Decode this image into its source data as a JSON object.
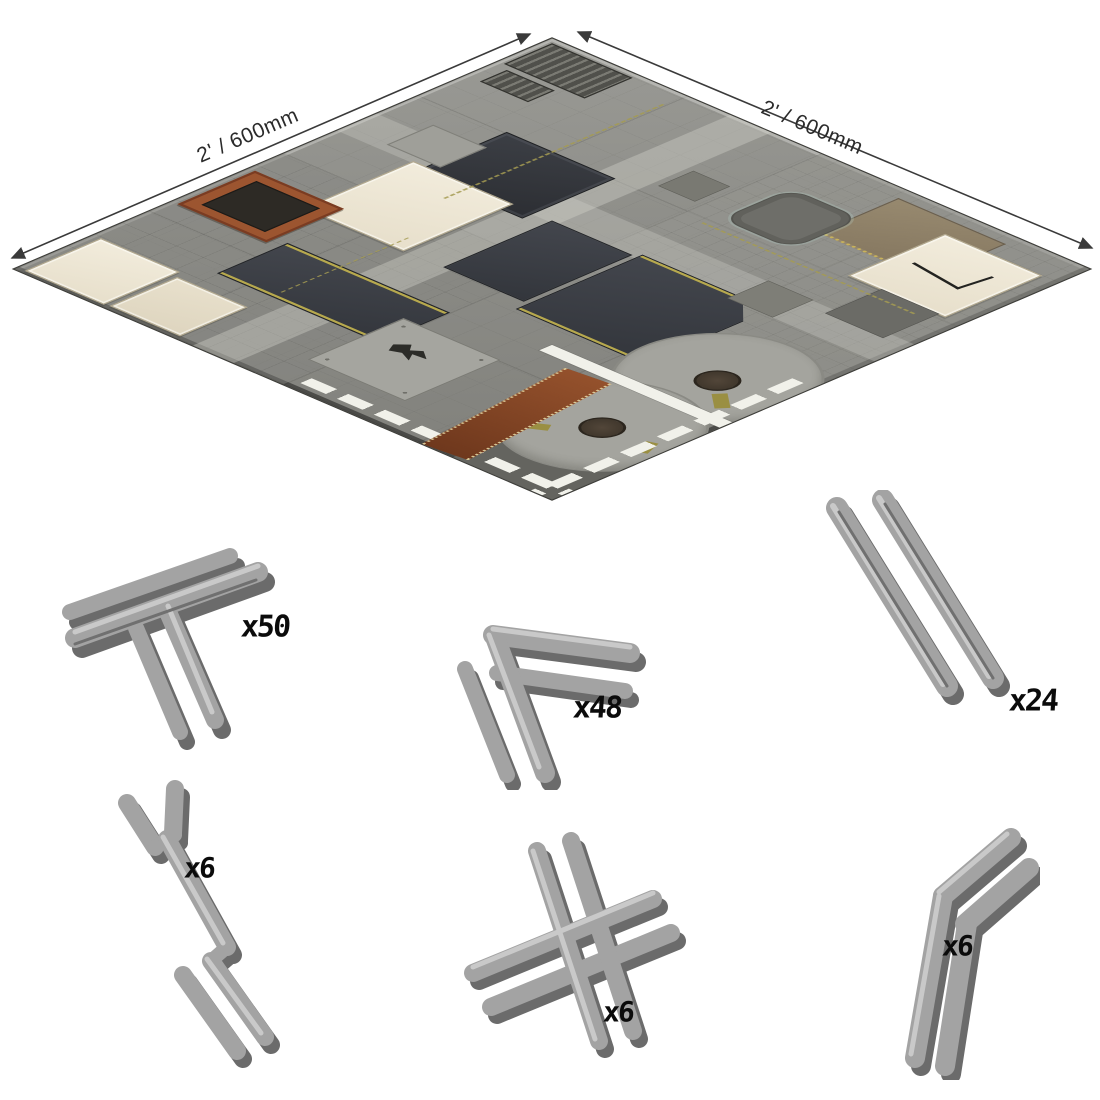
{
  "mat": {
    "description": "modular sci-fi industrial gaming mat, isometric view",
    "dimension_label_left": "2' / 600mm",
    "dimension_label_right": "2' / 600mm"
  },
  "clips": [
    {
      "id": "t-junction-clip",
      "shape": "T-junction connector clip",
      "quantity_label": "x50"
    },
    {
      "id": "corner-clip",
      "shape": "corner connector clip",
      "quantity_label": "x48"
    },
    {
      "id": "straight-clip",
      "shape": "straight edge connector clip",
      "quantity_label": "x24"
    },
    {
      "id": "offset-clip",
      "shape": "offset Z connector clip",
      "quantity_label": "x6"
    },
    {
      "id": "cross-clip",
      "shape": "cross connector clip",
      "quantity_label": "x6"
    },
    {
      "id": "angle-clip",
      "shape": "angled connector clip",
      "quantity_label": "x6"
    }
  ],
  "colors": {
    "board_grey": "#8f8f8b",
    "cream_panel": "#ece4d2",
    "navy_panel": "#3a3d44",
    "hazard_yellow": "#b7a94e",
    "rust": "#8a4527",
    "stripe_white": "#f1f1ea",
    "clip_grey": "#a3a3a3",
    "label_black": "#0b0b0b"
  }
}
